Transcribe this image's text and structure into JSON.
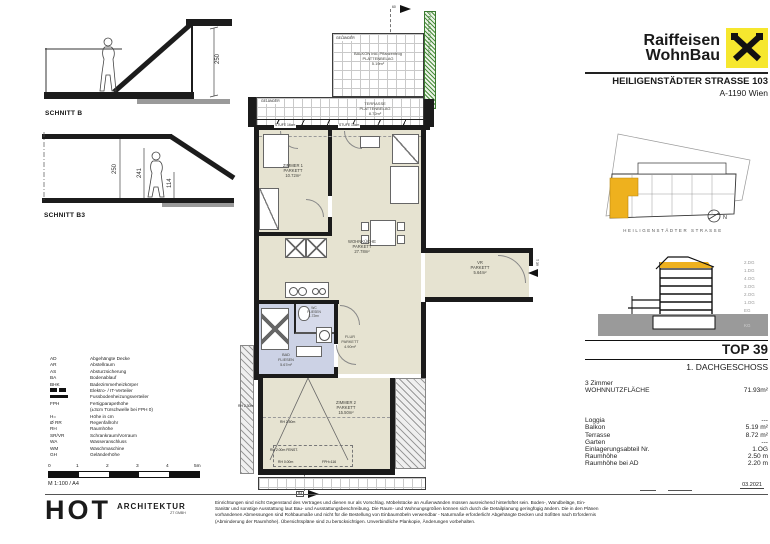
{
  "document": {
    "brand": {
      "line1": "Raiffeisen",
      "line2": "WohnBau"
    },
    "project": {
      "street": "HEILIGENSTÄDTER STRASSE 103",
      "city": "A-1190 Wien"
    },
    "date": "03.2021"
  },
  "site_plan": {
    "street_label": "HEILIGENSTÄDTER STRASSE",
    "north": "N"
  },
  "building_section": {
    "floors": [
      "2.DG",
      "1.DG",
      "4.OG",
      "3.OG",
      "2.OG",
      "1.OG",
      "EG",
      "KG"
    ]
  },
  "unit": {
    "top": "TOP 39",
    "floor": "1. DACHGESCHOSS",
    "rooms": "3 Zimmer",
    "area_label": "WOHNNUTZFLÄCHE",
    "area_value": "71.93m²",
    "details": [
      {
        "label": "Loggia",
        "value": "---"
      },
      {
        "label": "Balkon",
        "value": "5.19 m²"
      },
      {
        "label": "Terrasse",
        "value": "8.72 m²"
      },
      {
        "label": "Garten",
        "value": "---"
      },
      {
        "label": "Einlagerungsabteil Nr.",
        "value": "1.OG"
      },
      {
        "label": "Raumhöhe",
        "value": "2.50 m"
      },
      {
        "label": "Raumhöhe bei AD",
        "value": "2.20 m"
      }
    ]
  },
  "plan": {
    "rooms": [
      {
        "name": "ZIMMER 1",
        "finish": "PARKETT",
        "area": "10.72m²"
      },
      {
        "name": "WOHNKÜCHE",
        "finish": "PARKETT",
        "area": "27.78m²"
      },
      {
        "name": "VR",
        "finish": "PARKETT",
        "area": "5.64m²"
      },
      {
        "name": "WC",
        "finish": "FLIESEN",
        "area": "1.72m²"
      },
      {
        "name": "BAD",
        "finish": "FLIESEN",
        "area": "5.67m²"
      },
      {
        "name": "FLUR",
        "finish": "PARKETT",
        "area": "4.90m²"
      },
      {
        "name": "ZIMMER 2",
        "finish": "PARKETT",
        "area": "15.50m²"
      }
    ],
    "outdoor": [
      {
        "name": "BALKON inkl. Pflanzentrog",
        "finish": "PLATTENBELAG",
        "area": "5.19m²"
      },
      {
        "name": "TERRASSE",
        "finish": "PLATTENBELAG",
        "area": "8.72m²"
      }
    ],
    "labels": {
      "gelaender": "GELÄNDER",
      "pflanzentrog": "PFLANZENTROG",
      "stufe": "STUFE 16cm",
      "top_dim": "60",
      "entry": "T 39",
      "section_b3": "B3"
    },
    "annotations": {
      "rh1": "RH 2.30m",
      "rh2": "RH 2.50m",
      "rh3": "RH 2.00m FENST.",
      "rh4": "RH 0.00m",
      "fph": "FPH=116"
    }
  },
  "sections": {
    "b": {
      "label": "SCHNITT B",
      "dim": "250"
    },
    "b3": {
      "label": "SCHNITT B3",
      "dim1": "250",
      "dim2": "241",
      "dim3": "114"
    }
  },
  "legend": {
    "items": [
      {
        "abbr": "AD",
        "text": "Abgehängte Decke"
      },
      {
        "abbr": "AR",
        "text": "Abstellraum"
      },
      {
        "abbr": "AS",
        "text": "Absturzsicherung"
      },
      {
        "abbr": "BA",
        "text": "Bodenablauf"
      },
      {
        "abbr": "BHK",
        "text": "Badezimmerheizkörper"
      },
      {
        "abbr": "",
        "text": "Elektro- / IT-Verteiler"
      },
      {
        "abbr": "",
        "text": "Fussbodenheizungsverteiler"
      },
      {
        "abbr": "FPH",
        "text": "Fertigparapethöhe"
      },
      {
        "abbr": "",
        "text": "(±3cm Türschwelle bei FPH 0)"
      },
      {
        "abbr": "H=",
        "text": "Höhe in cm"
      },
      {
        "abbr": "Ø RR",
        "text": "Regenfallrohr"
      },
      {
        "abbr": "RH",
        "text": "Raumhöhe"
      },
      {
        "abbr": "SR/VR",
        "text": "Schrankraum/Vorraum"
      },
      {
        "abbr": "WA",
        "text": "Wasseranschluss"
      },
      {
        "abbr": "WM",
        "text": "Waschmaschine"
      },
      {
        "abbr": "GH",
        "text": "Geländerhöhe"
      }
    ]
  },
  "scalebar": {
    "ticks": [
      "0",
      "1",
      "2",
      "3",
      "4",
      "5m"
    ],
    "scale": "M 1:100 / A4"
  },
  "architect": {
    "name": "HOT",
    "field": "ARCHITEKTUR",
    "sub": "ZT GMBH"
  },
  "disclaimer": {
    "line1": "Einrichtungen sind nicht Gegenstand des Vertrages und dienen nur als Vorschlag. Möbelstücke an Außenwänden müssen ausreichend hinterlüftet sein. Boden-, Wandbeläge, Ein-",
    "line2": "Sanitär und sonstige Ausstattung laut Bau- und Ausstattungsbeschreibung. Die Raum- und Wohnungsgrößen können sich durch die Detailplanung geringfügig ändern. Die in den Plänen",
    "line3": "vorhandenen Abmessungen sind Rohbaumaße und nicht für die Bestellung von Einbaumöbeln verwendbar - Naturmaße erforderlich! Abgehängte Decken und Sofitten nach Erfordernis",
    "line4": "(Abminderung der Raumhöhe). Übersichtspläne sind zu berücksichtigen. Unverbindliche Plankopie, Änderungen vorbehalten."
  },
  "colors": {
    "brand_yellow": "#f6e72e",
    "unit_yellow": "#eeb11e",
    "room_beige": "#e6e3d1",
    "wet_blue": "#ccd2e5",
    "plant_green": "#4a8f3c"
  }
}
